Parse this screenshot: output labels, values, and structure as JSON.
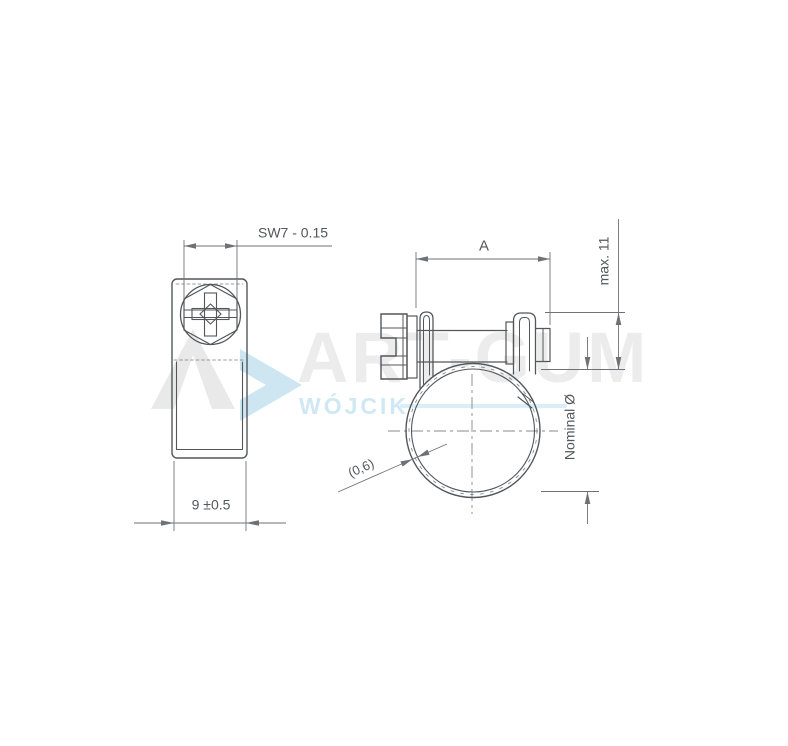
{
  "diagram": {
    "type": "technical-drawing",
    "subject": "mini hose clamp, two orthographic views with dimensions",
    "dimensions": {
      "hex_width": "SW7 - 0.15",
      "band_width": "9 ±0.5",
      "clamp_length": "A",
      "closure_height": "max. 11",
      "nominal_diameter": "Nominal Ø",
      "band_thickness": "(0,6)"
    },
    "watermark": {
      "brand": "ART-GUM",
      "subtitle": "WÓJCIK"
    },
    "colors": {
      "part_line": "#54575a",
      "dimension_line": "#6e7276",
      "centerline": "#85888b",
      "label_text": "#54575a",
      "watermark_gray": "#ececec",
      "watermark_blue": "#cfe8f4",
      "background": "#ffffff"
    }
  }
}
